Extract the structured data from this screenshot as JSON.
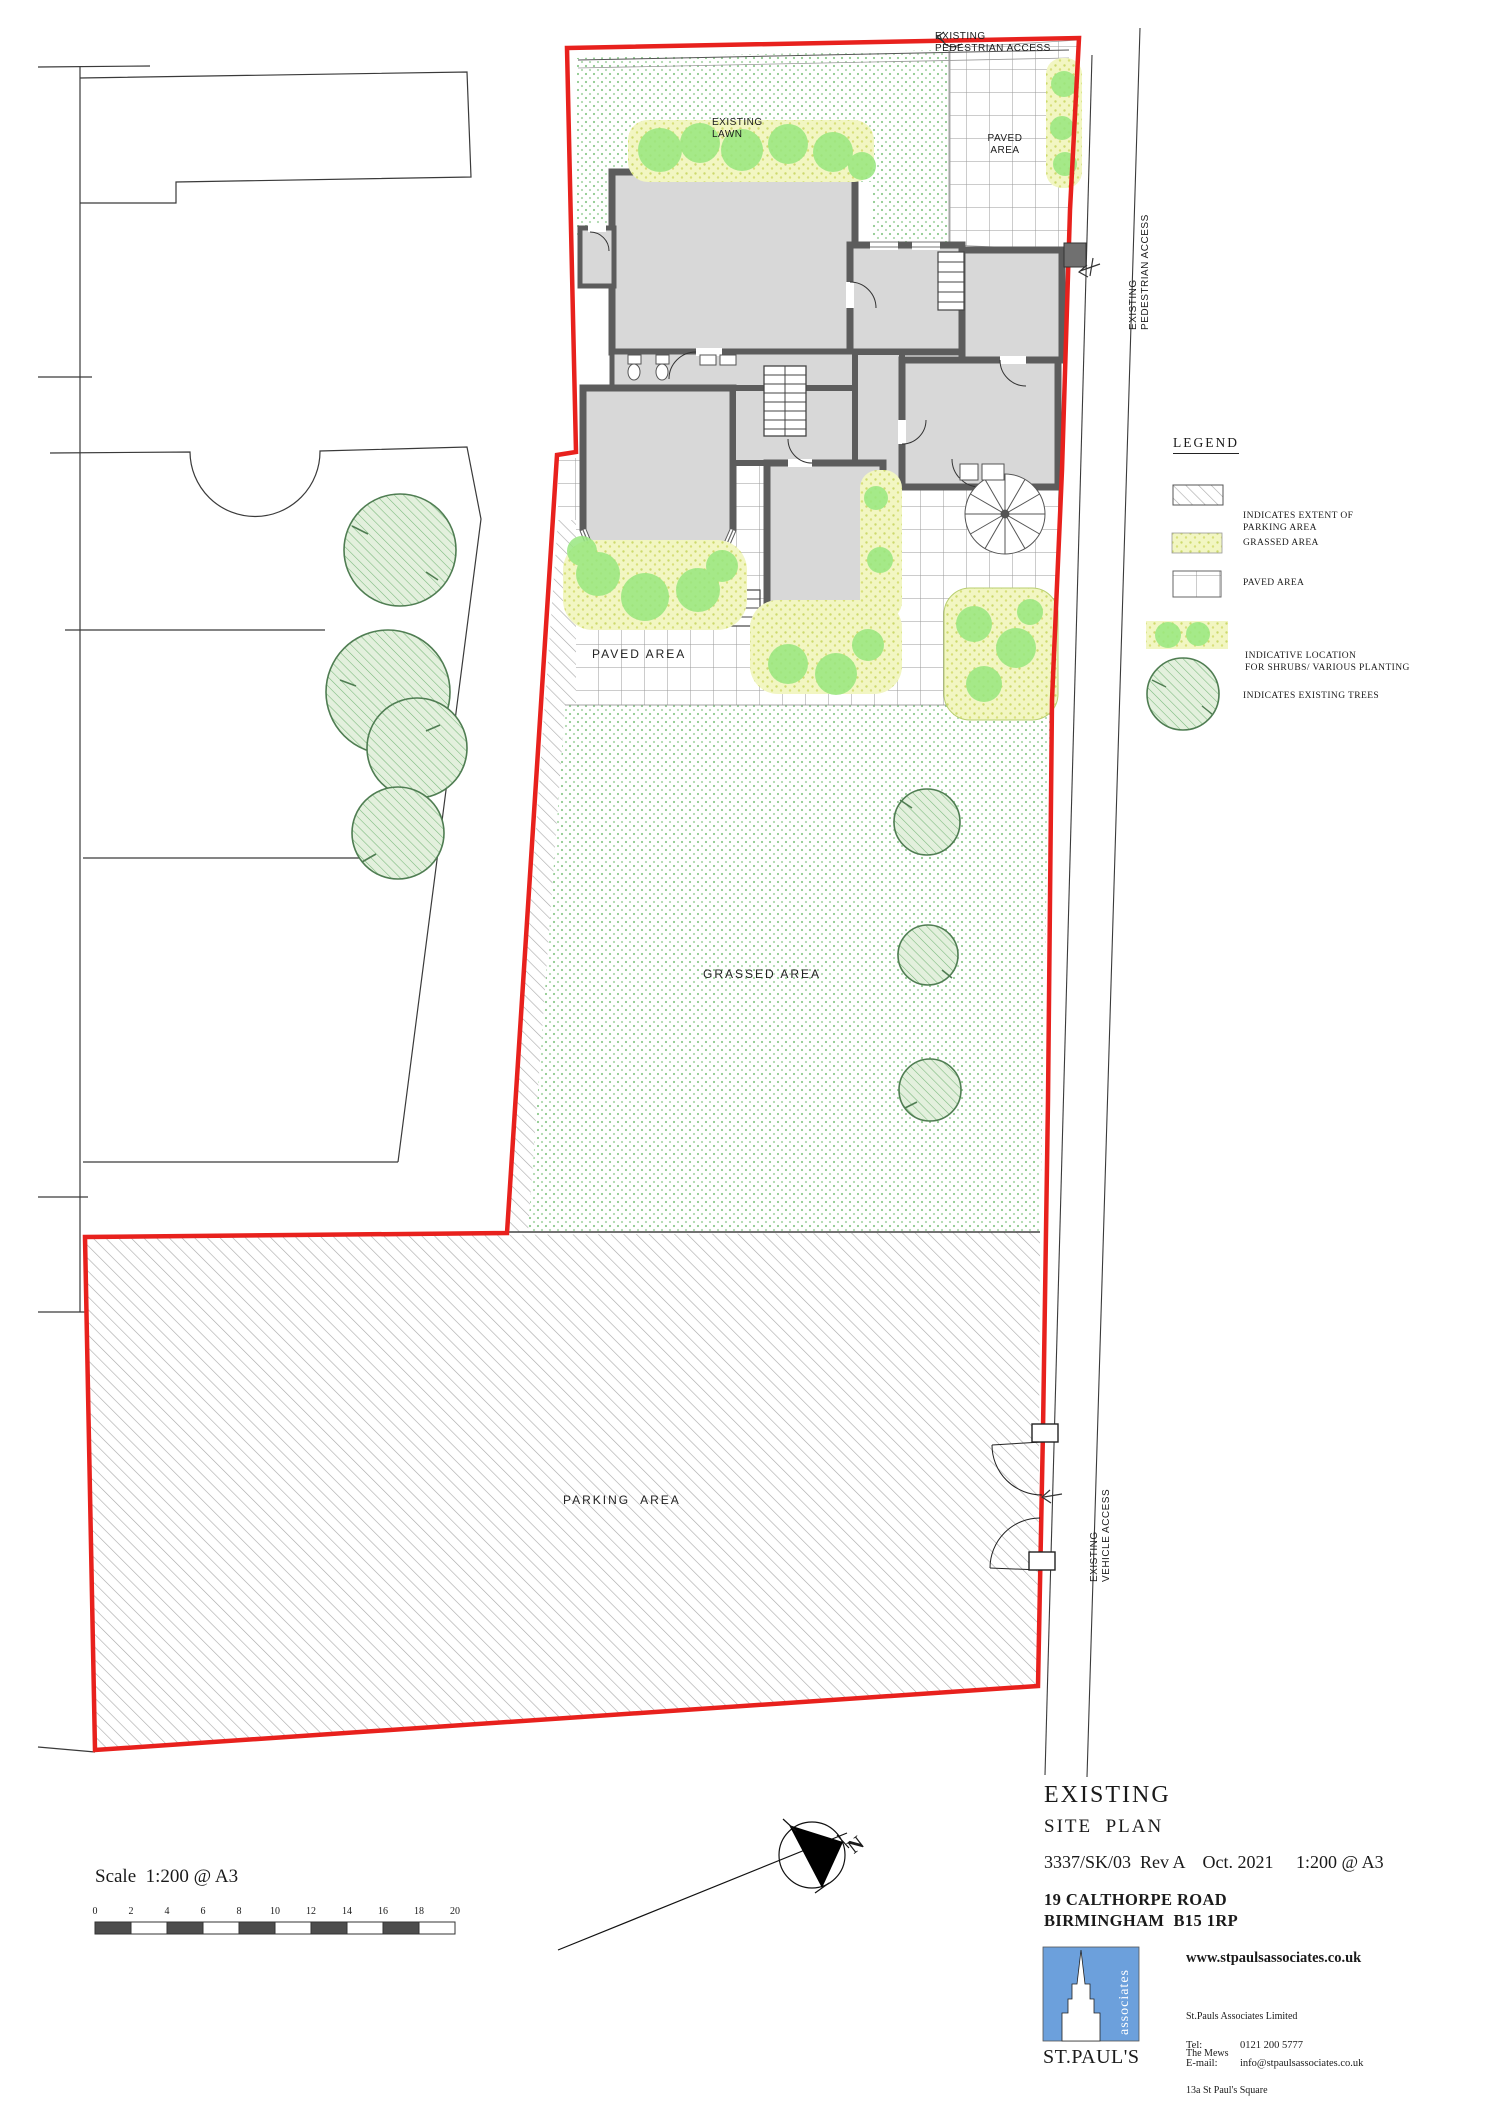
{
  "colors": {
    "boundary_red": "#e8211d",
    "shrub_green": "#98e77f",
    "logo_blue": "#6ca0dc",
    "wall_grey": "#5c5c5c"
  },
  "plan": {
    "top_access_line1": "EXISTING",
    "top_access_line2": "PEDESTRIAN ACCESS",
    "lawn_line1": "EXISTING",
    "lawn_line2": "LAWN",
    "paved_top_line1": "PAVED",
    "paved_top_line2": "AREA",
    "right_access_line1": "EXISTING",
    "right_access_line2": "PEDESTRIAN ACCESS",
    "paved_mid": "PAVED AREA",
    "grassed": "GRASSED AREA",
    "parking": "PARKING  AREA",
    "vehicle_access_line1": "EXISTING",
    "vehicle_access_line2": "VEHICLE ACCESS",
    "north": "N"
  },
  "legend": {
    "title": "LEGEND",
    "items": [
      {
        "line1": "INDICATES EXTENT OF",
        "line2": "PARKING AREA"
      },
      {
        "line1": "GRASSED AREA",
        "line2": ""
      },
      {
        "line1": "PAVED AREA",
        "line2": ""
      },
      {
        "line1": "INDICATIVE LOCATION",
        "line2": "FOR SHRUBS/ VARIOUS PLANTING"
      },
      {
        "line1": "INDICATES EXISTING TREES",
        "line2": ""
      }
    ]
  },
  "scalebar": {
    "label": "Scale  1:200 @ A3",
    "ticks": [
      "0",
      "2",
      "4",
      "6",
      "8",
      "10",
      "12",
      "14",
      "16",
      "18",
      "20"
    ]
  },
  "titleblock": {
    "title": "EXISTING",
    "subtitle": "SITE  PLAN",
    "reference": "3337/SK/03  Rev A    Oct. 2021     1:200 @ A3",
    "address_line1": "19 CALTHORPE ROAD",
    "address_line2": "BIRMINGHAM  B15 1RP",
    "website": "www.stpaulsassociates.co.uk",
    "company_line1": "St.Pauls Associates Limited",
    "company_line2": "The Mews",
    "company_line3": "13a St Paul's Square",
    "company_line4": "Birmingham B3 1RB",
    "tel_label": "Tel:",
    "tel_value": "0121 200 5777",
    "email_label": "E-mail:",
    "email_value": "info@stpaulsassociates.co.uk",
    "logo_vertical": "associates",
    "logo_name": "ST.PAUL'S"
  }
}
